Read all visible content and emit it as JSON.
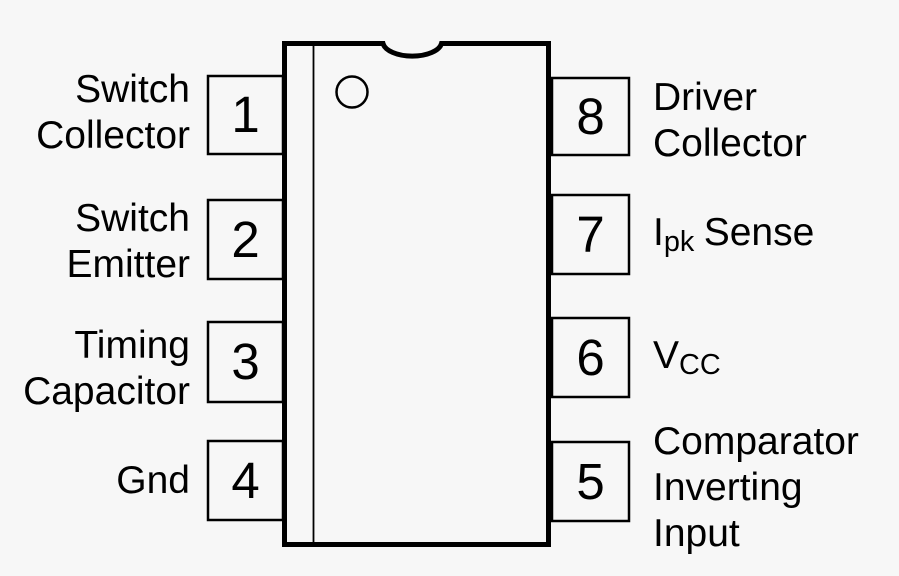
{
  "diagram": {
    "type": "ic-pinout-diagram",
    "colors": {
      "line": "#000000",
      "background": "#f7f7f7",
      "box_fill": "#f7f7f7"
    },
    "icons": {
      "package_notch": "top-center half-circle notch",
      "pin1_indicator": "small circle"
    },
    "pins_left": [
      {
        "number": "1",
        "lines": [
          "Switch",
          "Collector"
        ]
      },
      {
        "number": "2",
        "lines": [
          "Switch",
          "Emitter"
        ]
      },
      {
        "number": "3",
        "lines": [
          "Timing",
          "Capacitor"
        ]
      },
      {
        "number": "4",
        "lines": [
          "Gnd"
        ]
      }
    ],
    "pins_right": [
      {
        "number": "8",
        "lines": [
          "Driver",
          "Collector"
        ]
      },
      {
        "number": "7",
        "label": {
          "pre": "I",
          "sub": "pk",
          "post": "Sense"
        }
      },
      {
        "number": "6",
        "label": {
          "pre": "V",
          "sub": "CC",
          "post": ""
        }
      },
      {
        "number": "5",
        "lines": [
          "Comparator",
          "Inverting",
          "Input"
        ]
      }
    ]
  }
}
